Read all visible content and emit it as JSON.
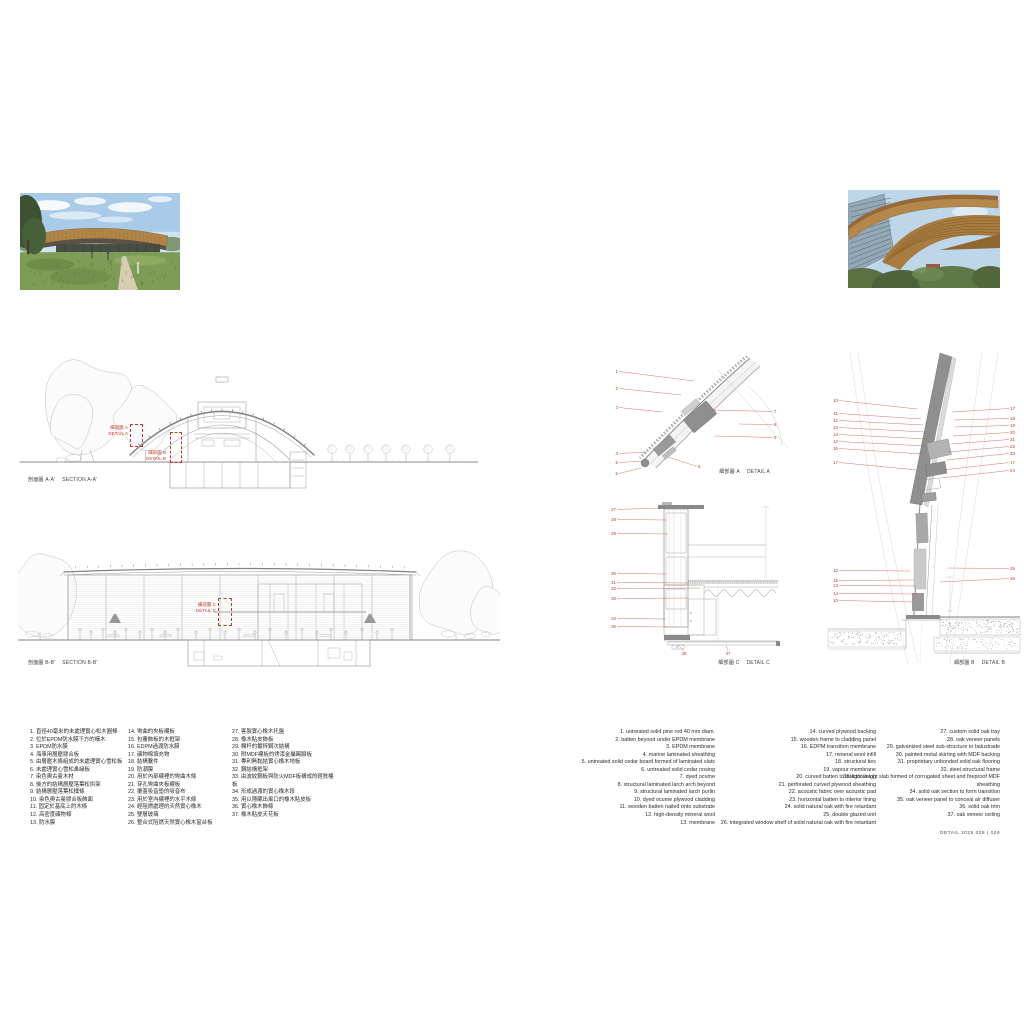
{
  "page": {
    "footer": "DETAIL 2025   028 | 029"
  },
  "colors": {
    "accent_red": "#c0392b",
    "drawing_gray": "#8f8f8f",
    "roof_brown": "#b5874a"
  },
  "photos": {
    "left": {
      "name": "exterior-photo"
    },
    "right": {
      "name": "roof-closeup-photo"
    }
  },
  "sections": {
    "a": {
      "caption_zh": "剖面圖 A-A'",
      "caption_en": "SECTION A-A'",
      "markers": [
        {
          "zh": "細部圖 A",
          "en": "DETAIL A"
        },
        {
          "zh": "細部圖 B",
          "en": "DETAIL B"
        }
      ]
    },
    "b": {
      "caption_zh": "剖面圖 B-B'",
      "caption_en": "SECTION B-B'",
      "markers": [
        {
          "zh": "細部圖 C",
          "en": "DETAIL C"
        }
      ]
    }
  },
  "details": {
    "a": {
      "caption_zh": "細部圖 A",
      "caption_en": "DETAIL A",
      "callouts": [
        {
          "n": "1",
          "x": 20,
          "y": 17,
          "x2": 96,
          "y2": 25,
          "a": "e"
        },
        {
          "n": "2",
          "x": 20,
          "y": 34,
          "x2": 83,
          "y2": 39,
          "a": "e"
        },
        {
          "n": "3",
          "x": 20,
          "y": 53,
          "x2": 64,
          "y2": 56,
          "a": "e"
        },
        {
          "n": "4",
          "x": 20,
          "y": 99,
          "x2": 49,
          "y2": 96,
          "a": "e"
        },
        {
          "n": "5",
          "x": 20,
          "y": 108,
          "x2": 45,
          "y2": 105,
          "a": "e"
        },
        {
          "n": "6",
          "x": 20,
          "y": 119,
          "x2": 43,
          "y2": 112,
          "a": "e"
        },
        {
          "n": "5",
          "x": 100,
          "y": 112,
          "x2": 70,
          "y2": 101,
          "a": "s"
        },
        {
          "n": "7",
          "x": 176,
          "y": 57,
          "x2": 113,
          "y2": 54,
          "a": "s"
        },
        {
          "n": "8",
          "x": 176,
          "y": 70,
          "x2": 141,
          "y2": 68,
          "a": "s"
        },
        {
          "n": "9",
          "x": 176,
          "y": 83,
          "x2": 117,
          "y2": 80,
          "a": "s"
        }
      ]
    },
    "c": {
      "caption_zh": "細部圖 C",
      "caption_en": "DETAIL C",
      "callouts": [
        {
          "n": "27",
          "x": 18,
          "y": 16,
          "x2": 62,
          "y2": 13,
          "a": "e"
        },
        {
          "n": "28",
          "x": 18,
          "y": 26,
          "x2": 68,
          "y2": 25,
          "a": "e"
        },
        {
          "n": "29",
          "x": 18,
          "y": 40,
          "x2": 70,
          "y2": 39,
          "a": "e"
        },
        {
          "n": "30",
          "x": 18,
          "y": 80,
          "x2": 68,
          "y2": 79,
          "a": "e"
        },
        {
          "n": "31",
          "x": 18,
          "y": 89,
          "x2": 90,
          "y2": 88,
          "a": "e"
        },
        {
          "n": "32",
          "x": 18,
          "y": 95,
          "x2": 102,
          "y2": 93,
          "a": "e"
        },
        {
          "n": "33",
          "x": 18,
          "y": 105,
          "x2": 90,
          "y2": 103,
          "a": "e"
        },
        {
          "n": "34",
          "x": 18,
          "y": 125,
          "x2": 68,
          "y2": 124,
          "a": "e"
        },
        {
          "n": "35",
          "x": 18,
          "y": 133,
          "x2": 70,
          "y2": 132,
          "a": "e"
        },
        {
          "n": "36",
          "x": 86,
          "y": 160,
          "x2": 80,
          "y2": 150,
          "a": "m"
        },
        {
          "n": "37",
          "x": 130,
          "y": 160,
          "x2": 128,
          "y2": 151,
          "a": "m"
        }
      ]
    },
    "b": {
      "caption_zh": "細部圖 B",
      "caption_en": "DETAIL B",
      "callouts": [
        {
          "n": "10",
          "x": 16,
          "y": 49,
          "x2": 95,
          "y2": 56,
          "a": "e"
        },
        {
          "n": "11",
          "x": 16,
          "y": 62,
          "x2": 99,
          "y2": 66,
          "a": "e"
        },
        {
          "n": "12",
          "x": 16,
          "y": 69,
          "x2": 101,
          "y2": 72,
          "a": "e"
        },
        {
          "n": "13",
          "x": 16,
          "y": 76,
          "x2": 103,
          "y2": 79,
          "a": "e"
        },
        {
          "n": "14",
          "x": 16,
          "y": 83,
          "x2": 104,
          "y2": 86,
          "a": "e"
        },
        {
          "n": "12",
          "x": 16,
          "y": 90,
          "x2": 103,
          "y2": 93,
          "a": "e"
        },
        {
          "n": "16",
          "x": 16,
          "y": 97,
          "x2": 101,
          "y2": 101,
          "a": "e"
        },
        {
          "n": "17",
          "x": 16,
          "y": 111,
          "x2": 95,
          "y2": 117,
          "a": "e"
        },
        {
          "n": "17",
          "x": 188,
          "y": 57,
          "x2": 130,
          "y2": 59,
          "a": "s"
        },
        {
          "n": "18",
          "x": 188,
          "y": 67,
          "x2": 132,
          "y2": 67,
          "a": "s"
        },
        {
          "n": "19",
          "x": 188,
          "y": 74,
          "x2": 133,
          "y2": 74,
          "a": "s"
        },
        {
          "n": "20",
          "x": 188,
          "y": 81,
          "x2": 131,
          "y2": 83,
          "a": "s"
        },
        {
          "n": "21",
          "x": 188,
          "y": 88,
          "x2": 129,
          "y2": 91,
          "a": "s"
        },
        {
          "n": "22",
          "x": 188,
          "y": 95,
          "x2": 127,
          "y2": 99,
          "a": "s"
        },
        {
          "n": "23",
          "x": 188,
          "y": 102,
          "x2": 125,
          "y2": 107,
          "a": "s"
        },
        {
          "n": "17",
          "x": 188,
          "y": 111,
          "x2": 121,
          "y2": 117,
          "a": "s"
        },
        {
          "n": "24",
          "x": 188,
          "y": 119,
          "x2": 119,
          "y2": 125,
          "a": "s"
        },
        {
          "n": "12",
          "x": 16,
          "y": 219,
          "x2": 88,
          "y2": 218,
          "a": "e"
        },
        {
          "n": "15",
          "x": 16,
          "y": 229,
          "x2": 92,
          "y2": 227,
          "a": "e"
        },
        {
          "n": "13",
          "x": 16,
          "y": 234,
          "x2": 94,
          "y2": 233,
          "a": "e"
        },
        {
          "n": "14",
          "x": 16,
          "y": 242,
          "x2": 95,
          "y2": 241,
          "a": "e"
        },
        {
          "n": "10",
          "x": 16,
          "y": 249,
          "x2": 90,
          "y2": 249,
          "a": "e"
        },
        {
          "n": "25",
          "x": 188,
          "y": 217,
          "x2": 126,
          "y2": 215,
          "a": "s"
        },
        {
          "n": "26",
          "x": 188,
          "y": 227,
          "x2": 118,
          "y2": 229,
          "a": "s"
        }
      ]
    }
  },
  "legend": {
    "zh_columns": [
      [
        "1. 直徑40毫米的未處理實心松木圓棒",
        "2. 位於EPDM防水膜下方的橫木",
        "3. EPDM防水膜",
        "4. 海事用層壓膠合板",
        "5. 由層壓木條組成的未處理實心雪松板",
        "6. 未處理實心雪松鼻緣板",
        "7. 染色奧古曼木材",
        "8. 後方的結構層壓落葉松拱架",
        "9. 結構層壓落葉松檁條",
        "10. 染色奧古曼膠合板飾面",
        "11. 固定於基底上的木條",
        "12. 高密度礦物棉",
        "13. 防水膜"
      ],
      [
        "14. 彎曲的夾板襯板",
        "15. 包覆飾板的木框架",
        "16. EDPM過渡防水膜",
        "17. 礦物棉填充物",
        "18. 結構繫件",
        "19. 防潮膜",
        "20. 用於內部襯裡的彎曲木條",
        "21. 穿孔彎曲夾板襯板",
        "22. 覆蓋吸音墊的吸音布",
        "23. 用於室內襯裡的水平木條",
        "24. 經阻燃處理的天然實心橡木",
        "25. 雙層玻璃",
        "26. 整合式阻燃天然實心橡木窗台板"
      ],
      [
        "27. 客製實心橡木托盤",
        "28. 橡木貼皮飾板",
        "29. 欄杆的鍍鋅鋼次結構",
        "30. 附MDF襯板的烤漆金屬踢腳板",
        "31. 專利無黏結實心橡木地板",
        "32. 鋼結構框架",
        "33. 由波紋鋼板與防火MDF板構成的輕質樓板",
        "34. 形成過渡的實心橡木段",
        "35. 用以隱藏出風口的橡木貼皮板",
        "36. 實心橡木飾條",
        "37. 橡木貼皮天花板"
      ]
    ],
    "en_columns": [
      [
        "1. untreated solid pine rod 40 mm diam.",
        "2. batten beyond under EPDM membrane",
        "3. EPDM membrane",
        "4. marine laminated sheathing",
        "5. untreated solid cedar board formed of laminated slats",
        "6. untreated solid cedar nosing",
        "7. dyed ocume",
        "8. structural laminated larch arch beyond",
        "9. structural laminated larch purlin",
        "10. dyed ocume plywood cladding",
        "11. wooden batten nailed onto substrate",
        "12. high-density mineral wool",
        "13. membrane"
      ],
      [
        "14. curved plywood backing",
        "15. wooden frame to cladding panel",
        "16. EDPM transition membrane",
        "17. mineral wool infill",
        "18. structural ties",
        "19. vapour membrane",
        "20. curved batten to interior lining",
        "21. perforated curved plywood sheathing",
        "22. acoustic fabric over acoustic pad",
        "23. horizontal batten to interior lining",
        "24. solid natural oak with fire retardant",
        "25. double glazed unit",
        "26. integrated window shelf of solid natural oak with fire retardant"
      ],
      [
        "27. custom solid oak tray",
        "28. oak veneer panels",
        "29. galvanized steel sub-structure to balustrade",
        "30. painted metal skirting with MDF backing",
        "31. proprietary unbonded solid oak flooring",
        "32. steel structural frame",
        "33. lightweight slab formed of corrugated sheet and fireproof MDF sheathing",
        "34. solid oak section to form transition",
        "35. oak veneer panel to conceal air diffuser",
        "36. solid oak trim",
        "37. oak veneer ceiling"
      ]
    ]
  }
}
